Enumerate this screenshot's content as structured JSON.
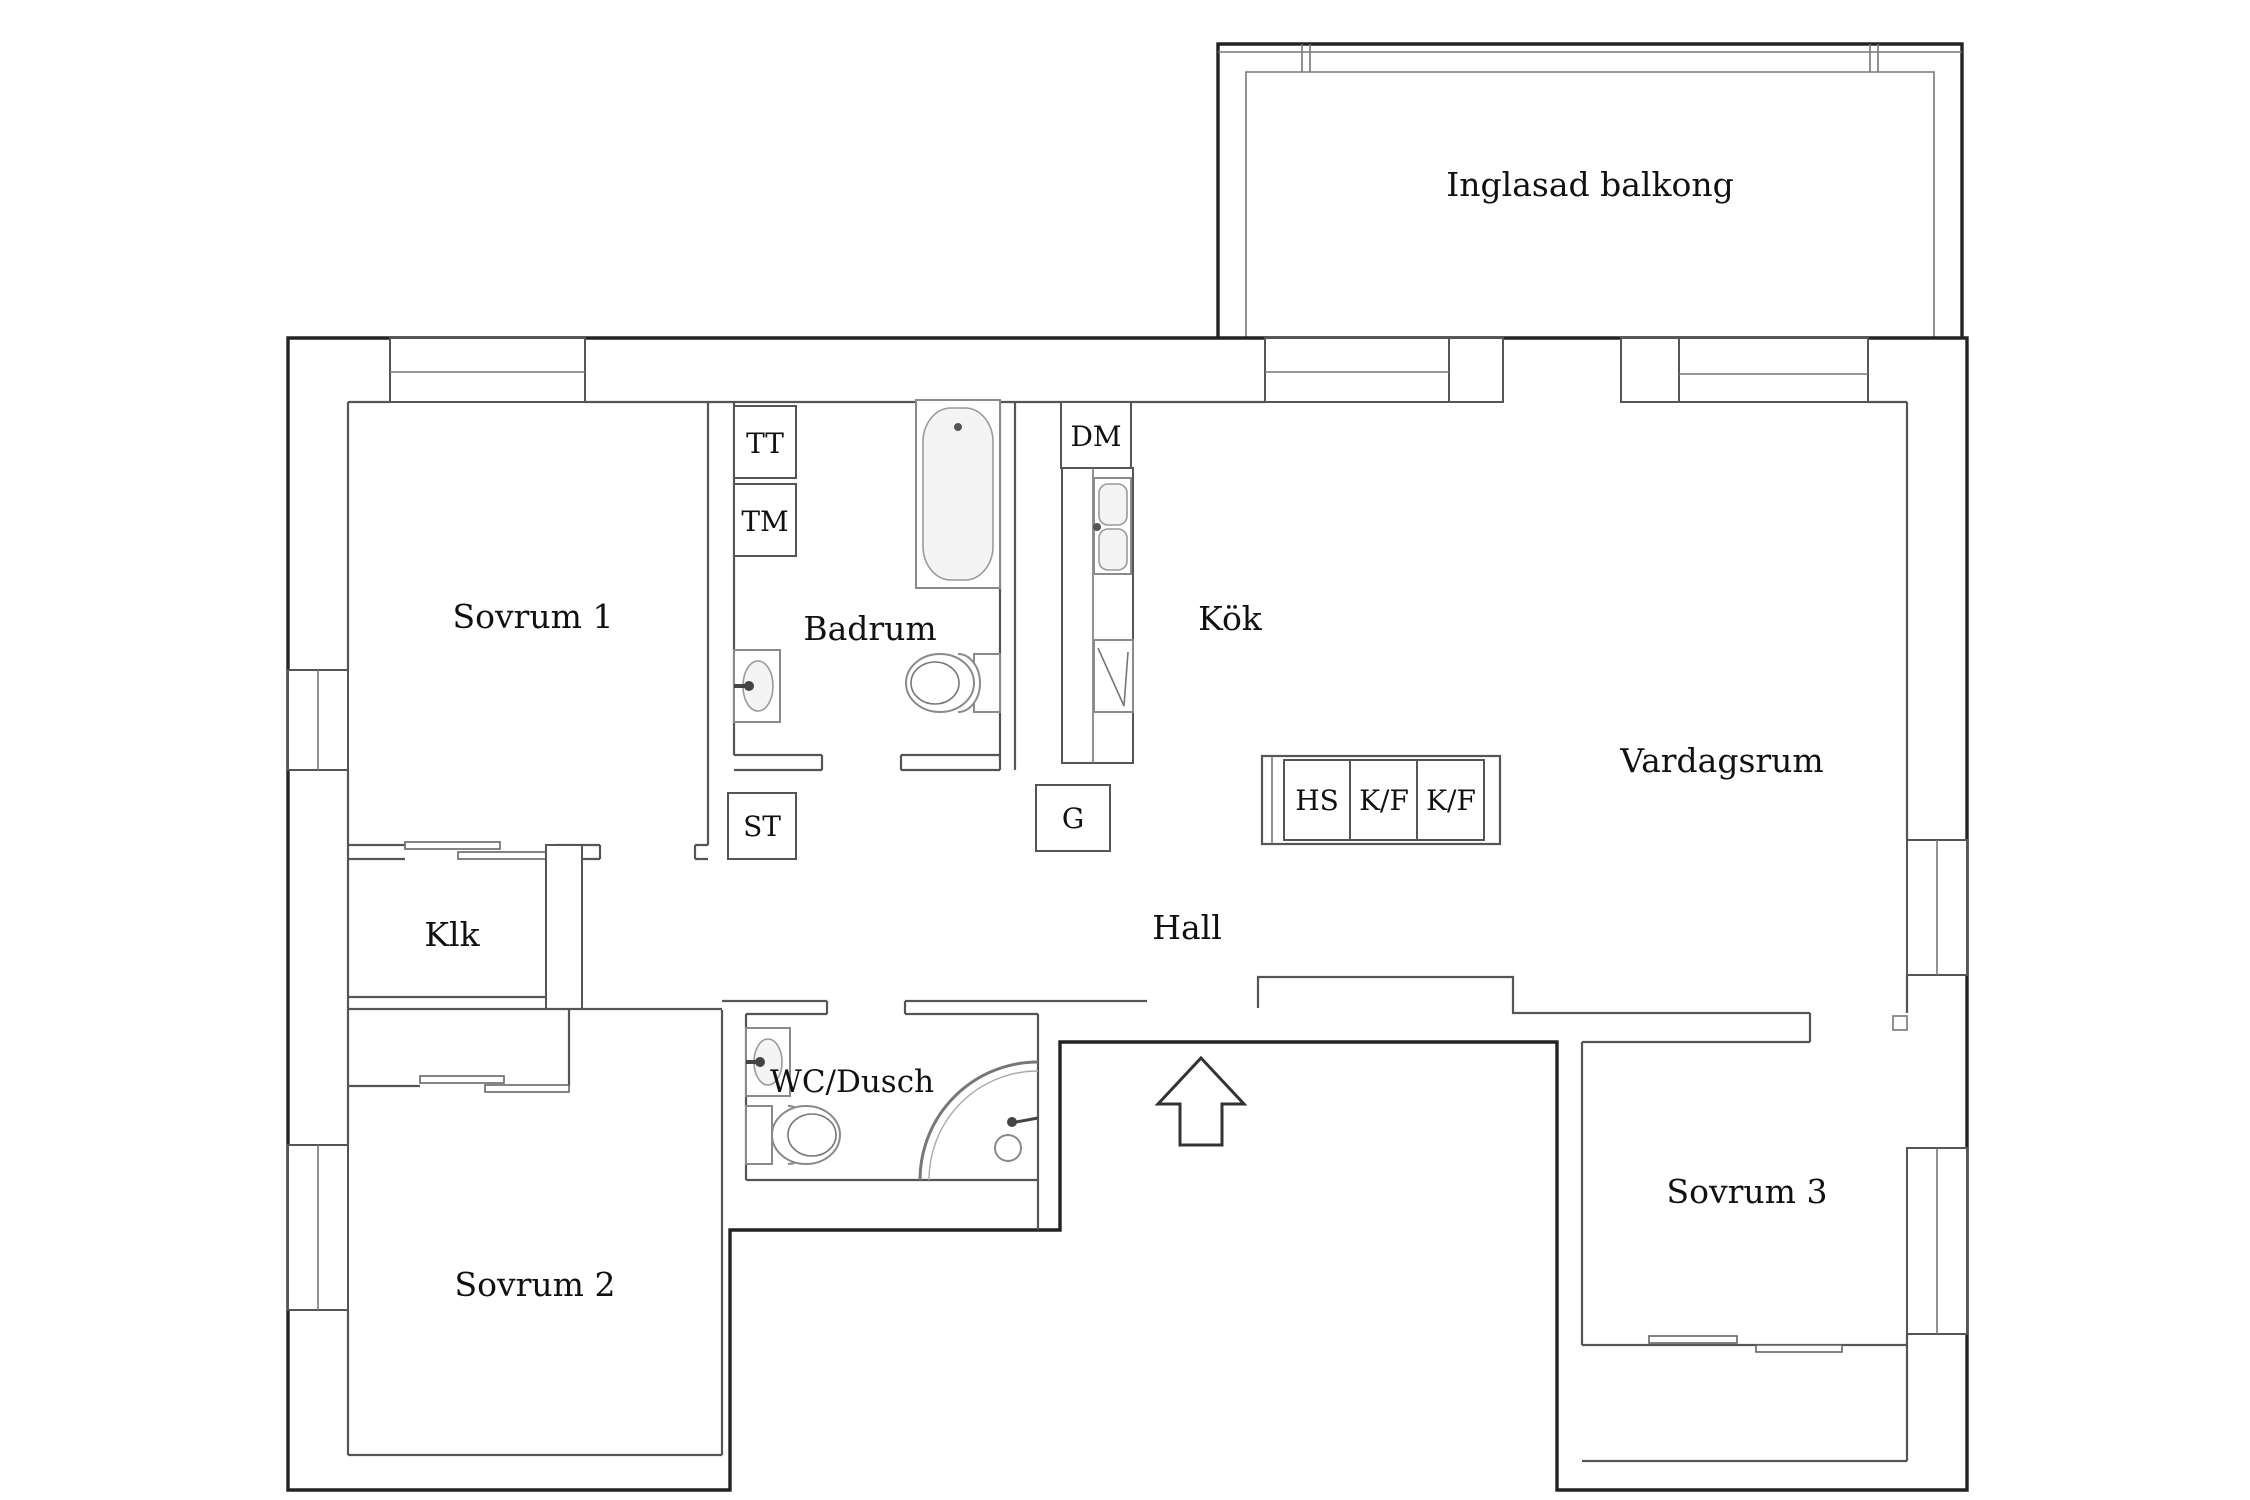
{
  "floorplan": {
    "type": "apartment-floor-plan",
    "colors": {
      "background": "#ffffff",
      "outer_wall": "#232323",
      "inner_wall": "#555555",
      "fixture_line": "#8a8a8a",
      "label_text": "#111111"
    },
    "rooms": {
      "balcony": {
        "label": "Inglasad balkong"
      },
      "bedroom1": {
        "label": "Sovrum 1"
      },
      "bathroom": {
        "label": "Badrum"
      },
      "kitchen": {
        "label": "Kök"
      },
      "living": {
        "label": "Vardagsrum"
      },
      "closet": {
        "label": "Klk"
      },
      "hall": {
        "label": "Hall"
      },
      "wc": {
        "label": "WC/Dusch"
      },
      "bedroom2": {
        "label": "Sovrum 2"
      },
      "bedroom3": {
        "label": "Sovrum 3"
      }
    },
    "appliances": {
      "tt": {
        "label": "TT"
      },
      "tm": {
        "label": "TM"
      },
      "st": {
        "label": "ST"
      },
      "dm": {
        "label": "DM"
      },
      "g": {
        "label": "G"
      },
      "hs": {
        "label": "HS"
      },
      "kf1": {
        "label": "K/F"
      },
      "kf2": {
        "label": "K/F"
      }
    }
  }
}
